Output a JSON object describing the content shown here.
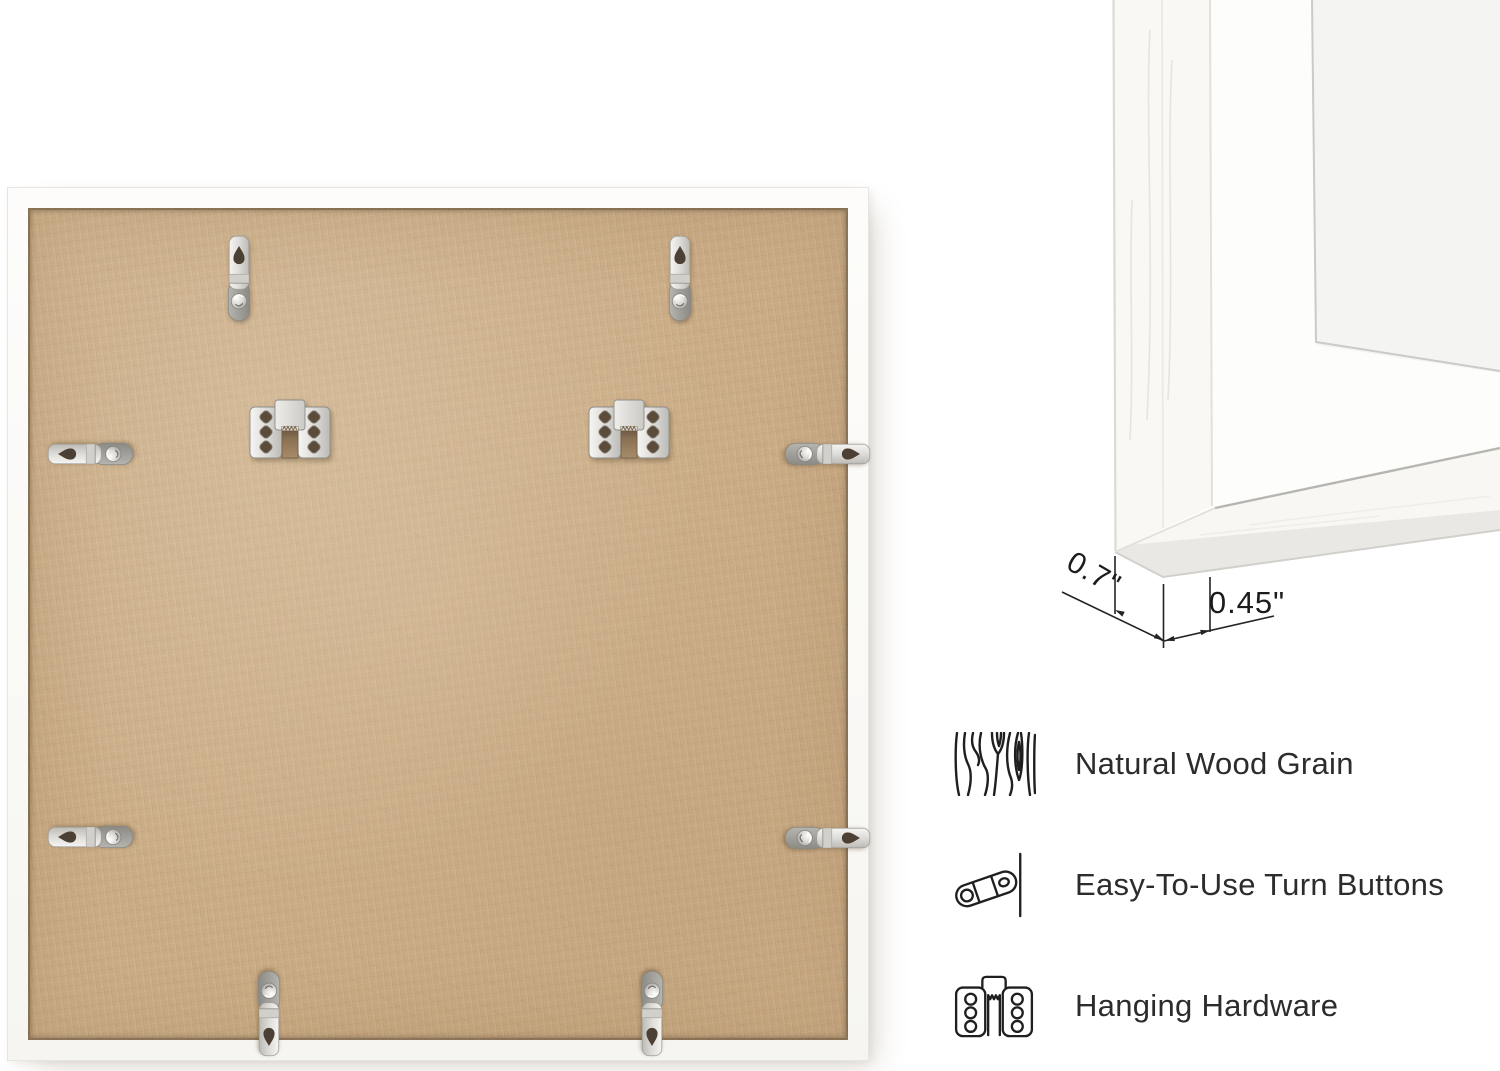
{
  "image_type": "picture frame product detail",
  "back_view": {
    "board_color": "#c9ab85",
    "frame_color": "#fbfaf8",
    "metal_color": "#d9d7d3",
    "turn_buttons_visible": 8,
    "hanging_plates_visible": 2
  },
  "corner_detail": {
    "measurements": [
      {
        "label": "0.7\""
      },
      {
        "label": "0.45\""
      }
    ],
    "line_color": "#242424"
  },
  "features": [
    {
      "icon": "wood-grain-icon",
      "label": "Natural Wood Grain"
    },
    {
      "icon": "turn-button-icon",
      "label": "Easy-To-Use Turn Buttons"
    },
    {
      "icon": "hanging-hardware-icon",
      "label": "Hanging Hardware"
    }
  ],
  "text_color": "#2c2c2c"
}
